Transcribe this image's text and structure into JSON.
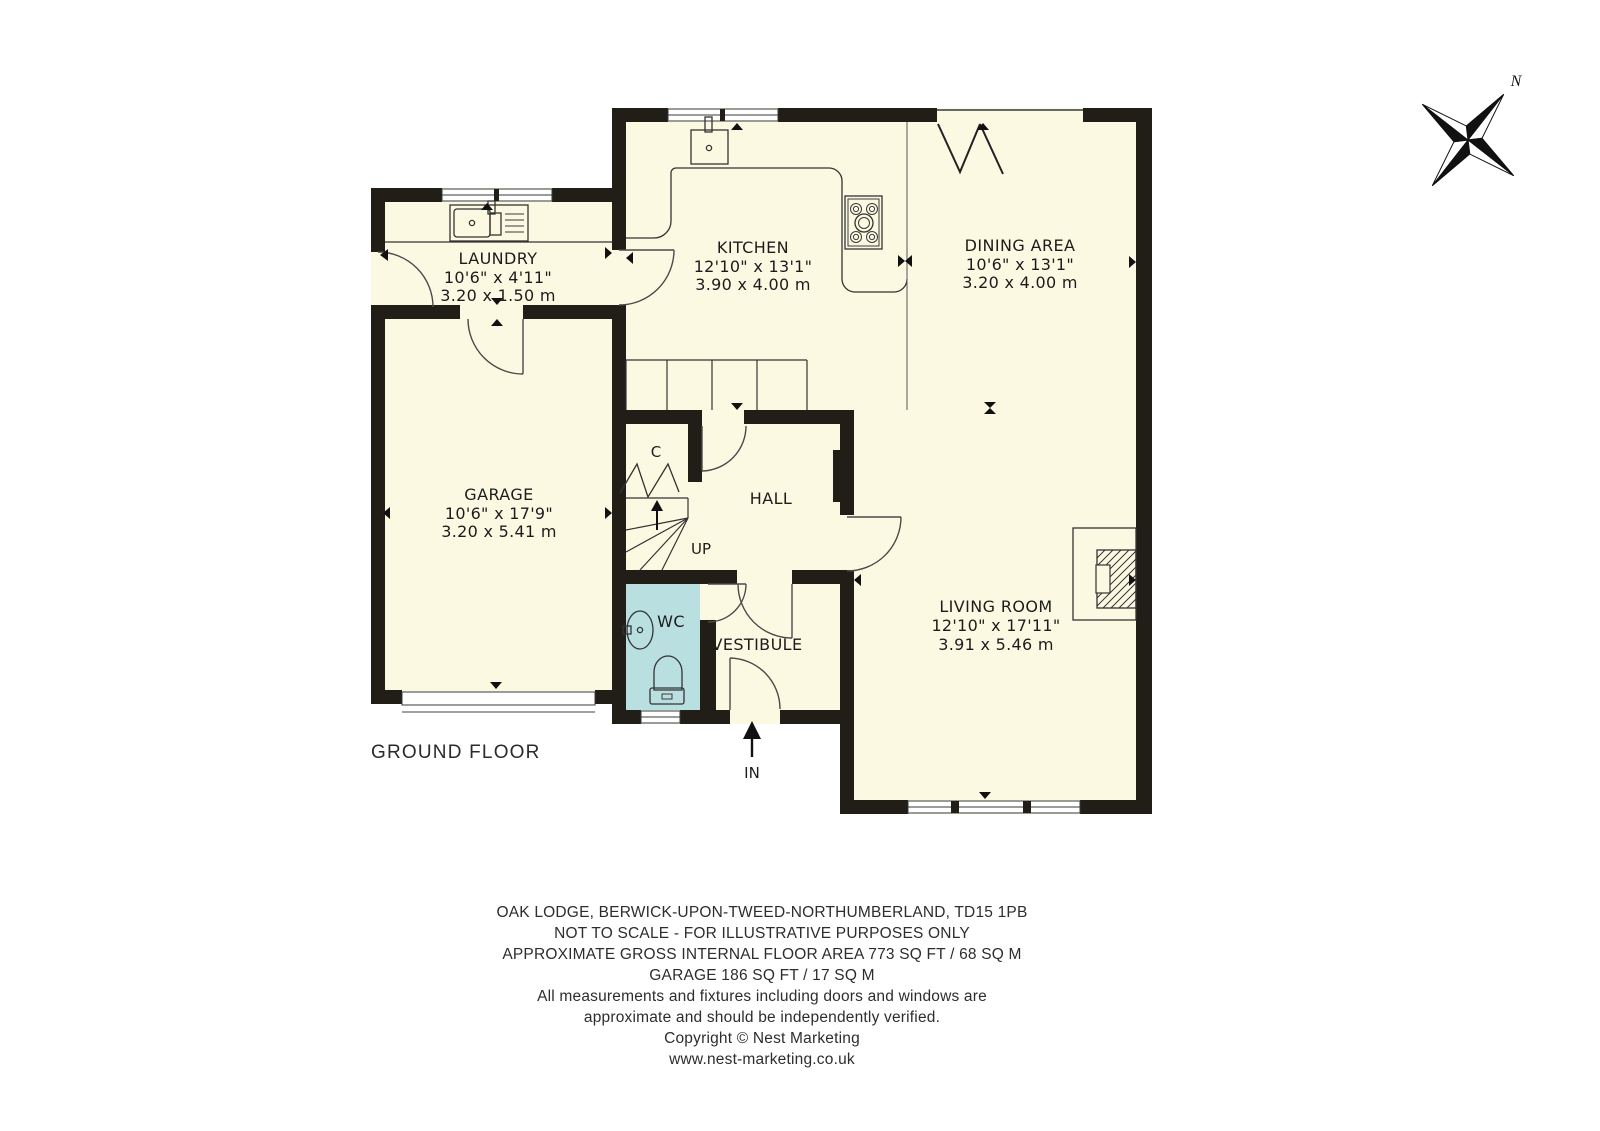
{
  "plan": {
    "floor_label": "GROUND FLOOR",
    "north_label": "N",
    "entrance_label": "IN",
    "stairs_label": "UP",
    "closet_label": "C",
    "rooms": [
      {
        "name": "LAUNDRY",
        "imperial": "10'6\" x 4'11\"",
        "metric": "3.20 x 1.50 m"
      },
      {
        "name": "KITCHEN",
        "imperial": "12'10\" x 13'1\"",
        "metric": "3.90 x 4.00 m"
      },
      {
        "name": "DINING AREA",
        "imperial": "10'6\" x 13'1\"",
        "metric": "3.20 x 4.00 m"
      },
      {
        "name": "GARAGE",
        "imperial": "10'6\" x 17'9\"",
        "metric": "3.20 x 5.41 m"
      },
      {
        "name": "HALL"
      },
      {
        "name": "WC"
      },
      {
        "name": "VESTIBULE"
      },
      {
        "name": "LIVING ROOM",
        "imperial": "12'10\" x 17'11\"",
        "metric": "3.91 x 5.46 m"
      }
    ],
    "colors": {
      "floor": "#FCF9E3",
      "wc_floor": "#B9DFE0",
      "wall": "#211E18",
      "line": "#333333"
    }
  },
  "footer": {
    "lines": [
      "OAK LODGE, BERWICK-UPON-TWEED-NORTHUMBERLAND, TD15 1PB",
      "NOT TO SCALE - FOR ILLUSTRATIVE PURPOSES ONLY",
      "APPROXIMATE GROSS INTERNAL FLOOR AREA 773 SQ FT / 68 SQ M",
      "GARAGE 186 SQ FT / 17 SQ M",
      "All measurements and fixtures including doors and windows are",
      "approximate and should be independently verified.",
      "Copyright © Nest Marketing",
      "www.nest-marketing.co.uk"
    ]
  }
}
